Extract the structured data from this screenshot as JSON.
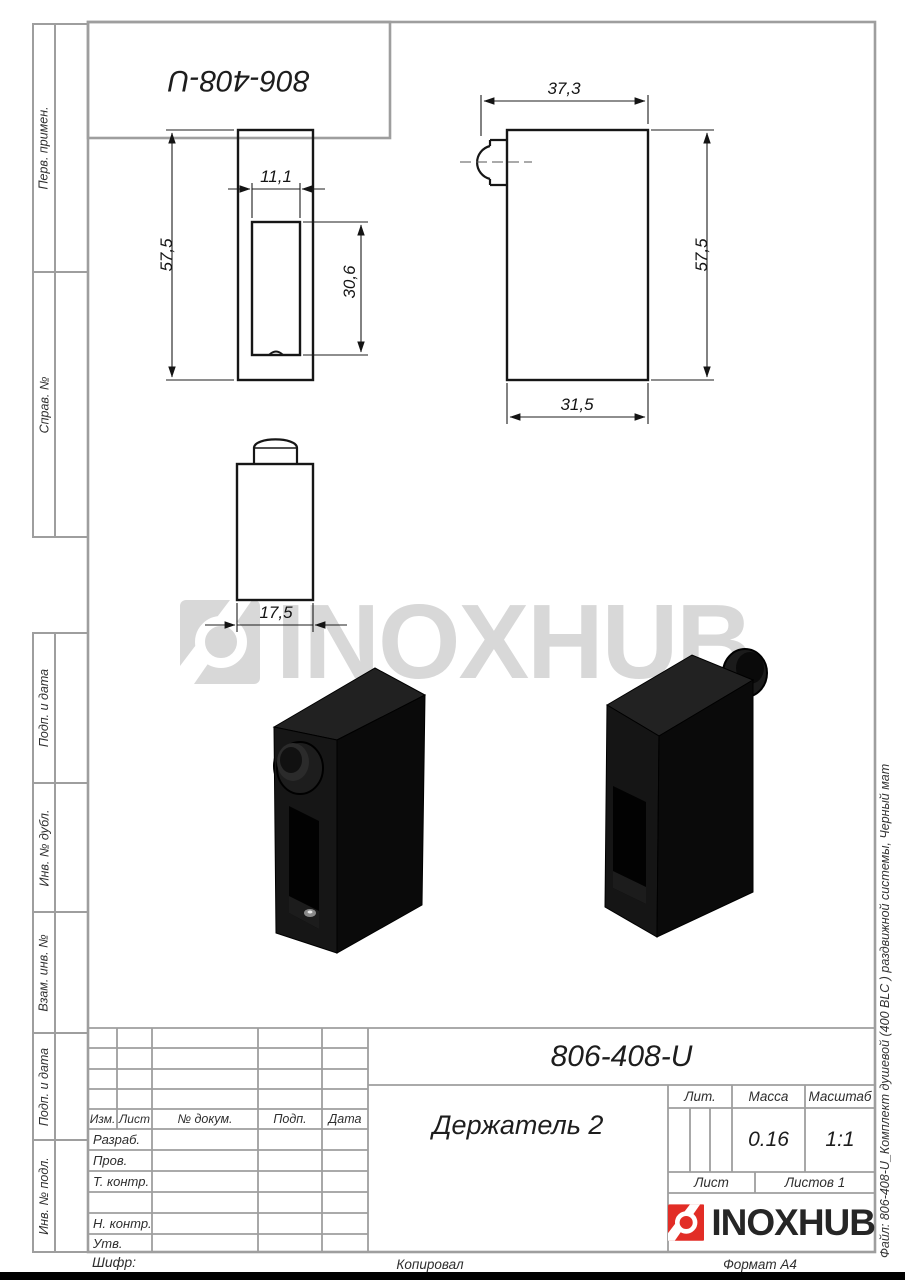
{
  "sheet": {
    "top_designation": "806-408-U",
    "cipher_label": "Шифр:",
    "copied_label": "Копировал",
    "format_label": "Формат A4",
    "file_note": "Файл: 806-408-U_Комплект душевой (400 BLC ) раздвижной системы, Черный мат",
    "watermark_text": "INOXHUB"
  },
  "sidebar": {
    "items": [
      {
        "label": "Перв. примен."
      },
      {
        "label": "Справ. №"
      },
      {
        "label": "Подп. и дата"
      },
      {
        "label": "Инв. № дубл."
      },
      {
        "label": "Взам. инв. №"
      },
      {
        "label": "Подп. и дата"
      },
      {
        "label": "Инв. № подл."
      }
    ]
  },
  "drawing": {
    "dims": {
      "front_height": "57,5",
      "slot_width": "11,1",
      "slot_depth": "30,6",
      "side_overall_width": "37,3",
      "side_height": "57,5",
      "side_body_width": "31,5",
      "top_width": "17,5"
    }
  },
  "title_block": {
    "designation": "806-408-U",
    "part_name": "Держатель 2",
    "col_izm": "Изм.",
    "col_list": "Лист",
    "col_doc": "№ докум.",
    "col_podp": "Подп.",
    "col_data": "Дата",
    "row_razrab": "Разраб.",
    "row_prov": "Пров.",
    "row_tkontr": "Т. контр.",
    "row_nkontr": "Н. контр.",
    "row_utv": "Утв.",
    "lit_label": "Лит.",
    "massa_label": "Масса",
    "masshtab_label": "Масштаб",
    "massa_value": "0.16",
    "masshtab_value": "1:1",
    "list_label": "Лист",
    "listov_label": "Листов 1",
    "logo_text": "INOXHUB"
  }
}
